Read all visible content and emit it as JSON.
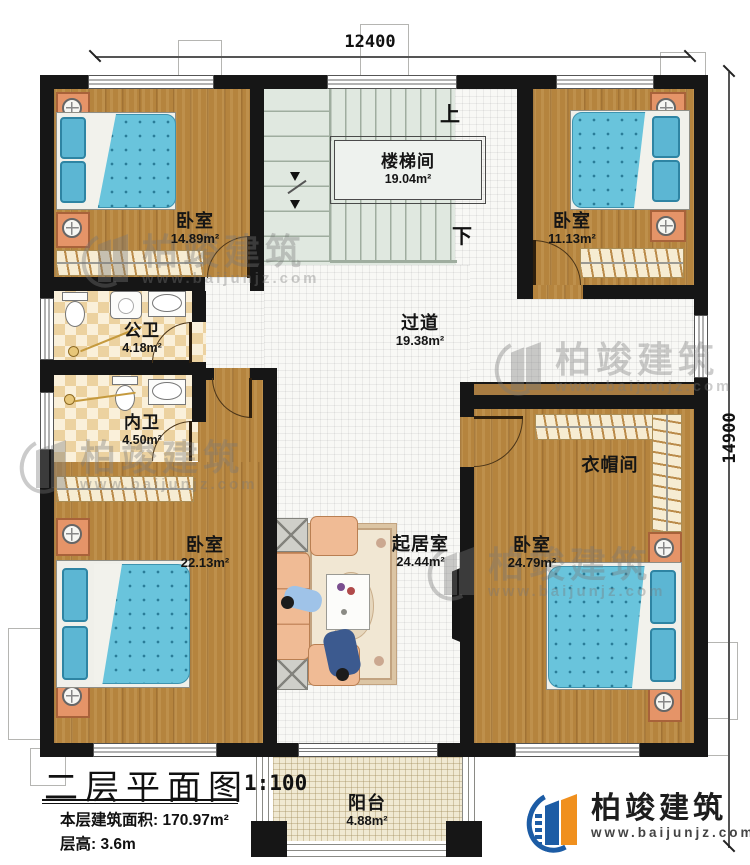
{
  "dimensions": {
    "width_label": "12400",
    "height_label": "14900"
  },
  "rooms": [
    {
      "name": "卧室",
      "area": "14.89m²"
    },
    {
      "name": "楼梯间",
      "area": "19.04m²"
    },
    {
      "name": "卧室",
      "area": "11.13m²"
    },
    {
      "name": "公卫",
      "area": "4.18m²"
    },
    {
      "name": "内卫",
      "area": "4.50m²"
    },
    {
      "name": "过道",
      "area": "19.38m²"
    },
    {
      "name": "衣帽间",
      "area": ""
    },
    {
      "name": "卧室",
      "area": "22.13m²"
    },
    {
      "name": "起居室",
      "area": "24.44m²"
    },
    {
      "name": "卧室",
      "area": "24.79m²"
    },
    {
      "name": "阳台",
      "area": "4.88m²"
    }
  ],
  "stairs": {
    "up": "上",
    "down": "下"
  },
  "title_block": {
    "plan_title": "二层平面图",
    "scale": "1:100",
    "area_label": "本层建筑面积:",
    "area_value": "170.97m²",
    "height_label": "层高:",
    "height_value": "3.6m"
  },
  "branding": {
    "company": "柏竣建筑",
    "website": "www.baijunjz.com"
  },
  "watermark": {
    "company": "柏竣建筑",
    "website": "www.baijunjz.com"
  },
  "colors": {
    "wall": "#161616",
    "wood_floor": "#b5843e",
    "bed_blue": "#69c4dc",
    "logo_blue": "#1c5ca5",
    "logo_orange": "#f0901e"
  }
}
